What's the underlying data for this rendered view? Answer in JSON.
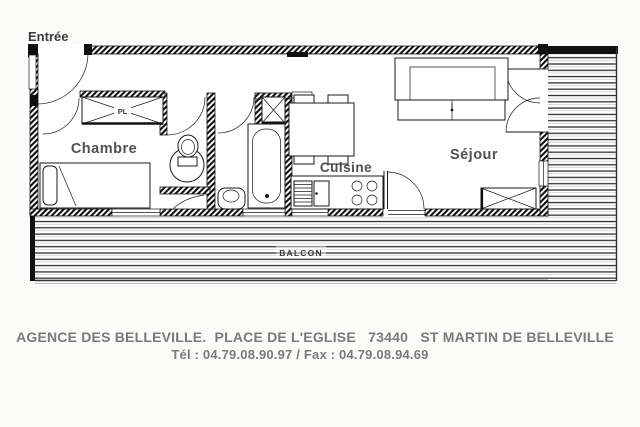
{
  "plan": {
    "labels": {
      "entree": "Entrée",
      "chambre": "Chambre",
      "cuisine": "Cuisine",
      "sejour": "Séjour",
      "balcon": "BALCON",
      "placard": "PL"
    },
    "colors": {
      "line": "#1a1a1a",
      "room_label": "#4f4f4f",
      "entry_label": "#3d3d3d",
      "balcon_label": "#3a3a3a",
      "footer_text": "#7a7a7a",
      "background": "#fbfbf9"
    }
  },
  "footer": {
    "line1": "AGENCE DES BELLEVILLE.  PLACE DE L'EGLISE   73440   ST MARTIN DE BELLEVILLE",
    "line2": "Tél : 04.79.08.90.97 / Fax : 04.79.08.94.69"
  }
}
